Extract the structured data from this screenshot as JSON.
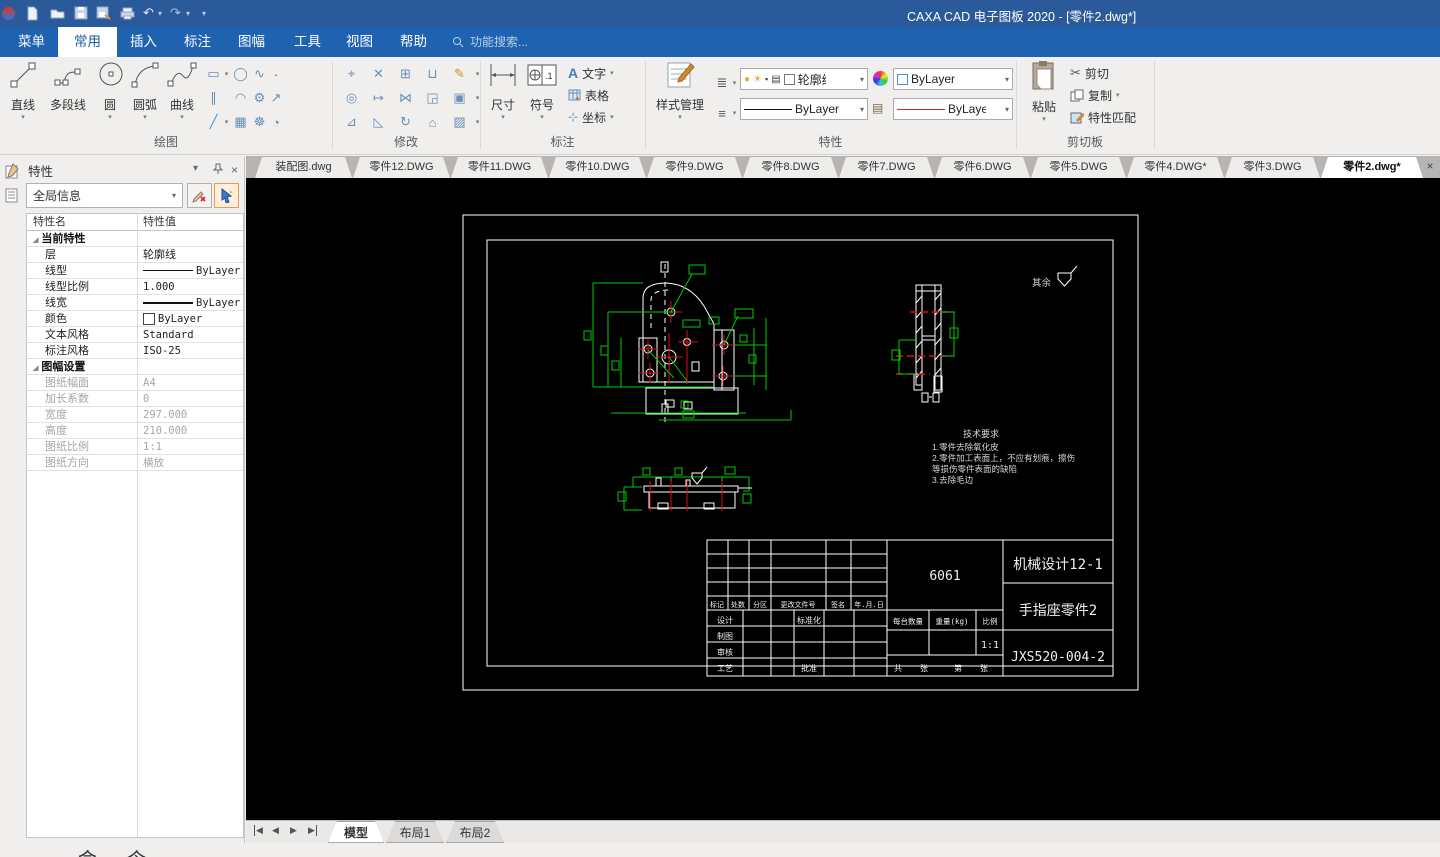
{
  "app": {
    "title": "CAXA CAD 电子图板 2020 - [零件2.dwg*]"
  },
  "colors": {
    "titlebar": "#2a5a99",
    "menubar": "#1f63b0",
    "outline": "#ffffff",
    "dimension": "#00cc00",
    "centerline": "#dd1111"
  },
  "quick_access": {
    "icons": [
      "app-logo",
      "new",
      "open",
      "save",
      "save-as",
      "print",
      "undo",
      "redo",
      "toolbar-options"
    ]
  },
  "menu": {
    "items": [
      "菜单",
      "常用",
      "插入",
      "标注",
      "图幅",
      "工具",
      "视图",
      "帮助"
    ],
    "active": "常用",
    "search_placeholder": "功能搜索..."
  },
  "ribbon": {
    "draw": {
      "label": "绘图",
      "tools": [
        "直线",
        "多段线",
        "圆",
        "圆弧",
        "曲线"
      ]
    },
    "modify": {
      "label": "修改"
    },
    "annotate": {
      "label": "标注",
      "dimension": "尺寸",
      "symbol": "符号",
      "text": "文字",
      "table": "表格",
      "coord": "坐标"
    },
    "props": {
      "label": "特性",
      "style_manager": "样式管理",
      "layer": "轮廓线",
      "color": "ByLayer",
      "linetype": "ByLayer",
      "dimstyle": "ByLayer"
    },
    "clipboard": {
      "label": "剪切板",
      "paste": "粘贴",
      "cut": "剪切",
      "copy": "复制",
      "match": "特性匹配"
    }
  },
  "doc_tabs": [
    "装配图.dwg",
    "零件12.DWG",
    "零件11.DWG",
    "零件10.DWG",
    "零件9.DWG",
    "零件8.DWG",
    "零件7.DWG",
    "零件6.DWG",
    "零件5.DWG",
    "零件4.DWG*",
    "零件3.DWG",
    "零件2.dwg*"
  ],
  "panel": {
    "title": "特性",
    "selector": "全局信息",
    "col_name": "特性名",
    "col_value": "特性值",
    "group1": "当前特性",
    "rows1": [
      {
        "name": "层",
        "value": "轮廓线"
      },
      {
        "name": "线型",
        "value": "ByLayer"
      },
      {
        "name": "线型比例",
        "value": "1.000"
      },
      {
        "name": "线宽",
        "value": "ByLayer"
      },
      {
        "name": "颜色",
        "value": "ByLayer"
      },
      {
        "name": "文本风格",
        "value": "Standard"
      },
      {
        "name": "标注风格",
        "value": "ISO-25"
      }
    ],
    "group2": "图幅设置",
    "rows2": [
      {
        "name": "图纸幅面",
        "value": "A4"
      },
      {
        "name": "加长系数",
        "value": "0"
      },
      {
        "name": "宽度",
        "value": "297.000"
      },
      {
        "name": "高度",
        "value": "210.000"
      },
      {
        "name": "图纸比例",
        "value": "1:1"
      },
      {
        "name": "图纸方向",
        "value": "横放"
      }
    ]
  },
  "drawing": {
    "surface_note": "其余",
    "tech_req": {
      "title": "技术要求",
      "lines": [
        "1.零件去除氧化皮",
        "2.零件加工表面上，不应有划痕，擦伤",
        "等损伤零件表面的缺陷",
        "3.去除毛边"
      ]
    },
    "title_block": {
      "material": "6061",
      "class_name": "机械设计12-1",
      "part_name": "手指座零件2",
      "drawing_no": "JXS520-004-2",
      "scale_value": "1:1",
      "rev_labels": [
        "标记",
        "处数",
        "分区",
        "更改文件号",
        "签名",
        "年.月.日"
      ],
      "role_labels": [
        "设计",
        "制图",
        "审核",
        "工艺"
      ],
      "std_label": "标准化",
      "approve_label": "批准",
      "qty_label": "每台数量",
      "weight_label": "重量(kg)",
      "scale_label": "比例",
      "sheet_labels": [
        "共",
        "张",
        "第",
        "张"
      ]
    }
  },
  "sheet_tabs": {
    "tabs": [
      "模型",
      "布局1",
      "布局2"
    ],
    "active": "模型"
  },
  "status": {
    "partial_text": "命令"
  }
}
